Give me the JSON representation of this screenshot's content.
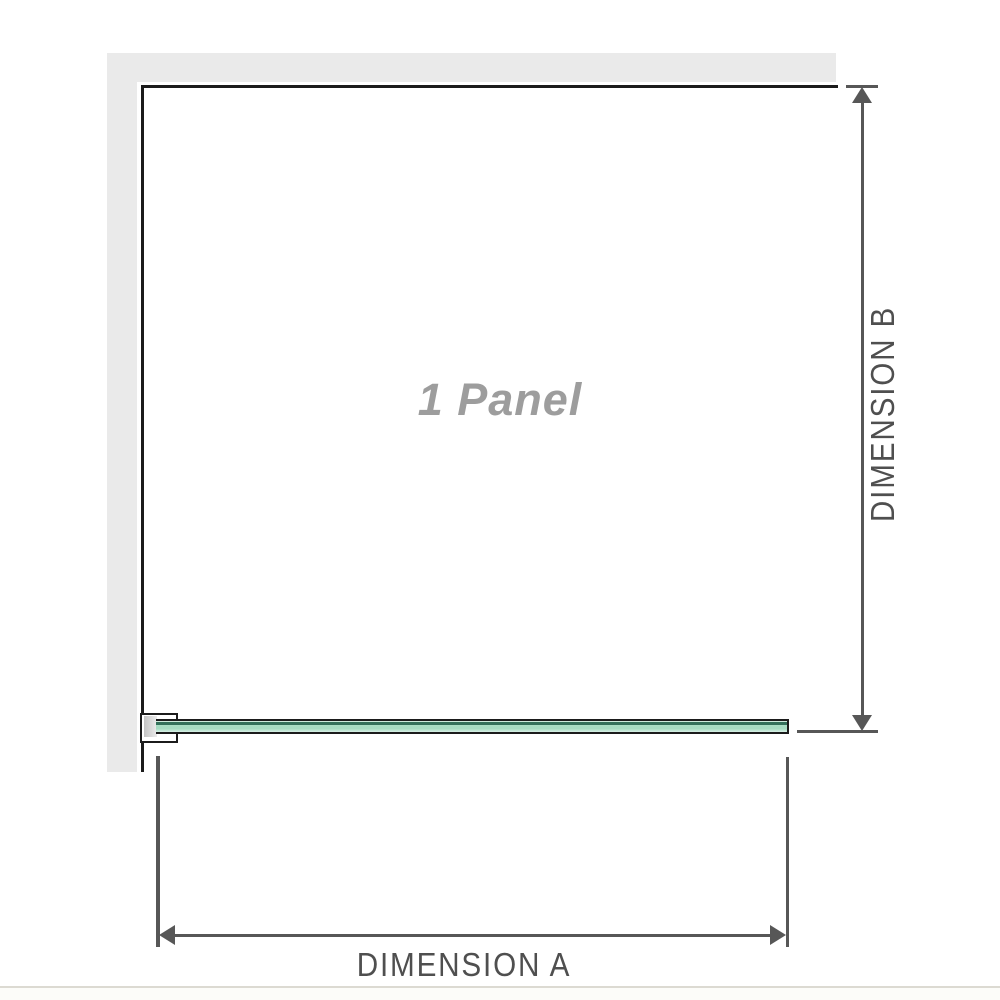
{
  "diagram": {
    "panel_label": "1 Panel",
    "dimension_a_label": "DIMENSION A",
    "dimension_b_label": "DIMENSION B"
  },
  "colors": {
    "wall_fill": "#eaeaea",
    "outline": "#1b1b1b",
    "dimension": "#575757",
    "label_text": "#4f4f4f",
    "panel_label_text": "#9d9d9d",
    "glass_light": "#d2ecdf",
    "glass_mid": "#a6dcc2",
    "glass_pale": "#d8efe5",
    "glass_dark_line": "#33705a",
    "separator": "#dcdad2"
  }
}
